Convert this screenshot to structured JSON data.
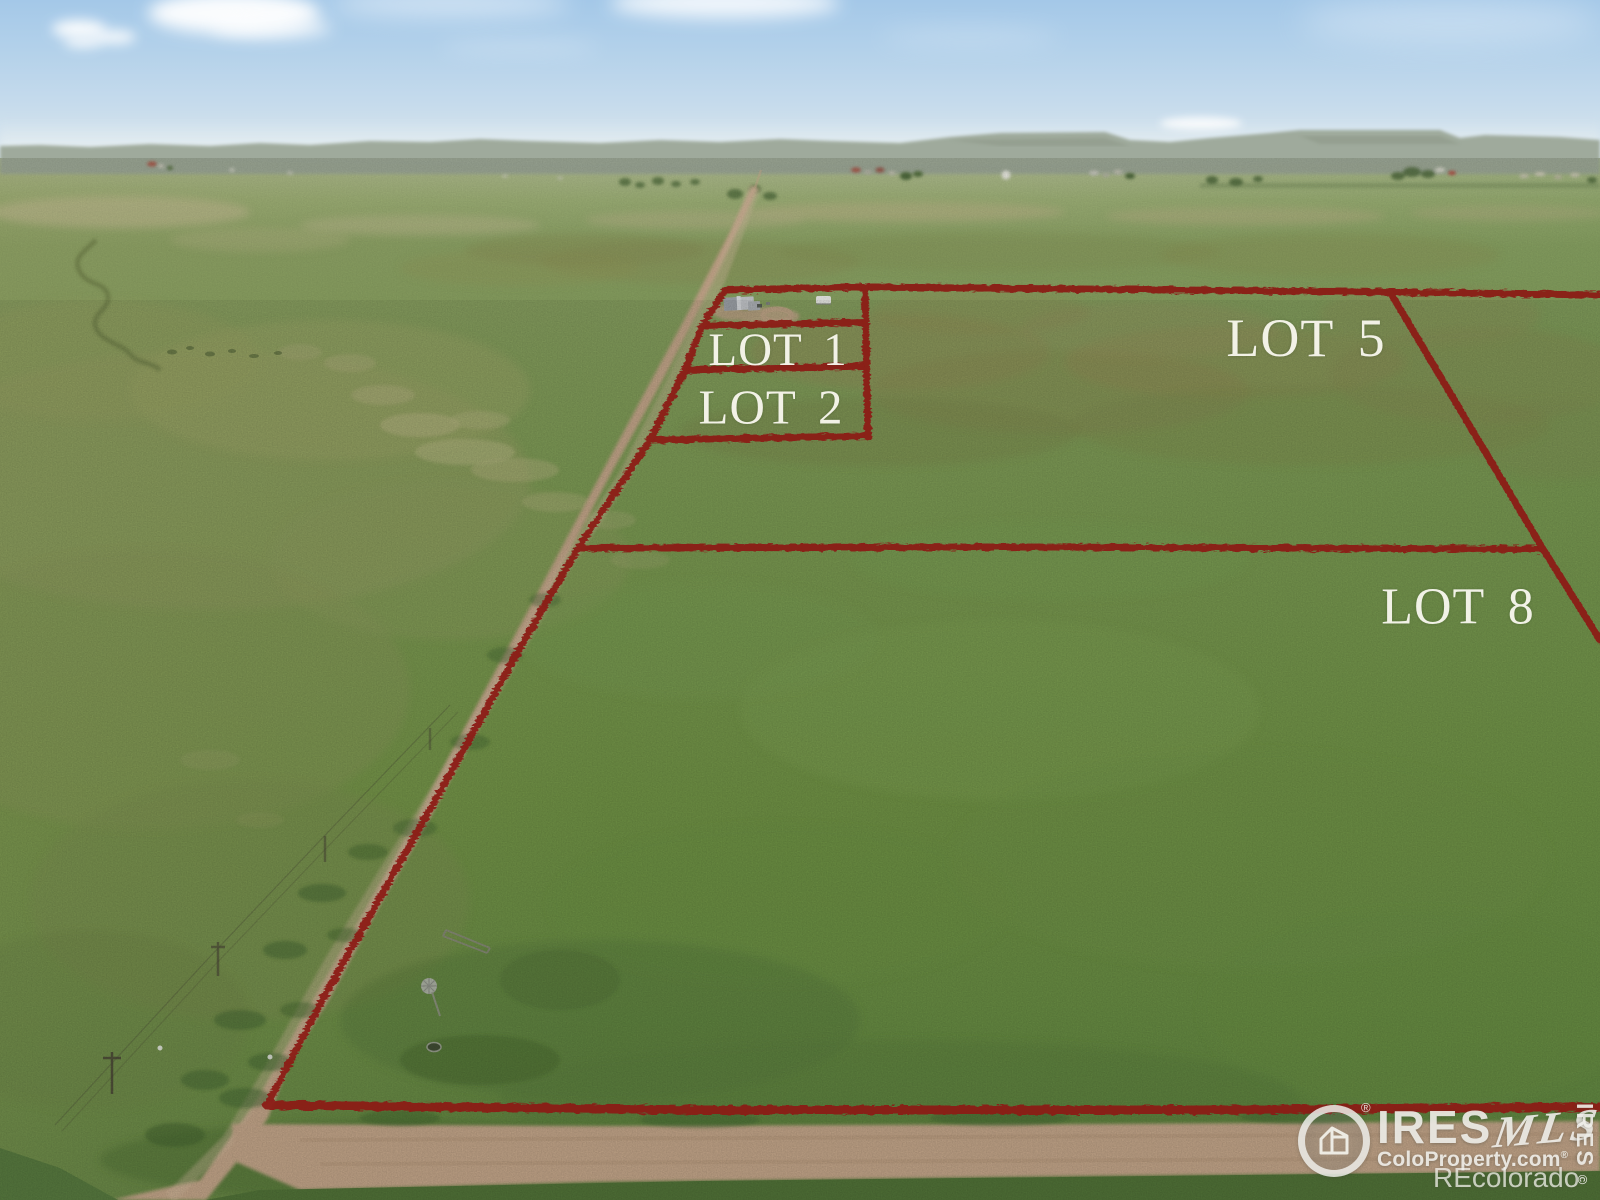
{
  "photo": {
    "lots": [
      {
        "label": "LOT 1"
      },
      {
        "label": "LOT 2"
      },
      {
        "label": "LOT 5"
      },
      {
        "label": "LOT 8"
      }
    ]
  },
  "colors": {
    "boundary": "#8c1a18",
    "label_text": "#f6f5ec"
  },
  "watermark": {
    "brand": "IRES",
    "brand_reg": "®",
    "mls": "MLS",
    "site": "ColoProperty.com",
    "site_reg": "®",
    "portal": "REcolorado",
    "side_text": "IRES",
    "side_copyright": "©"
  }
}
